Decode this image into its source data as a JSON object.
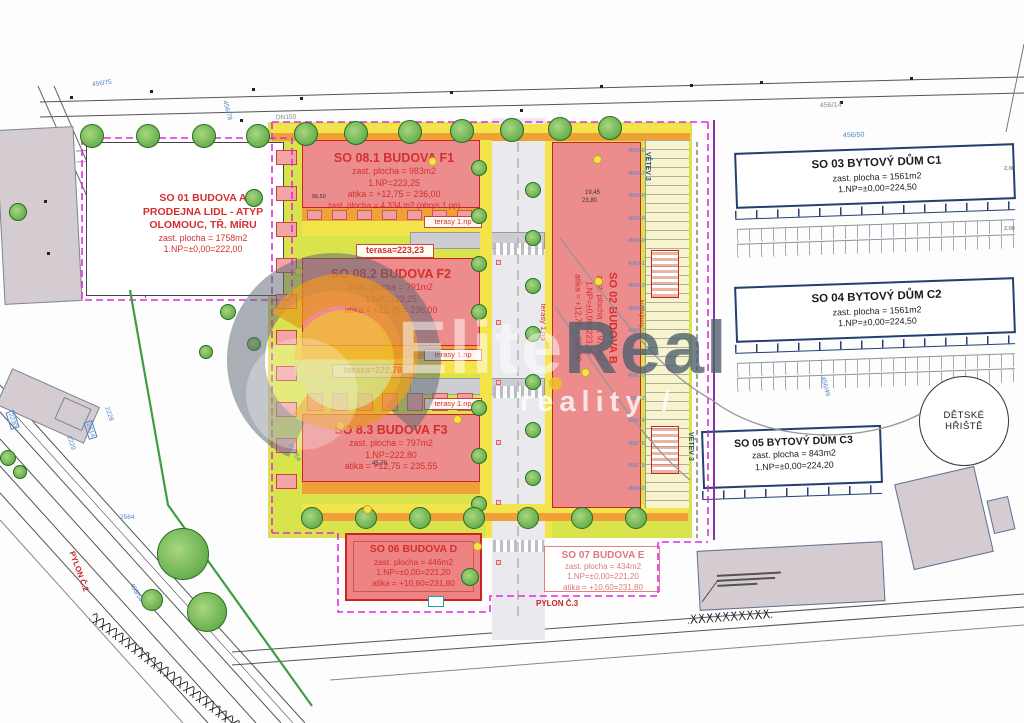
{
  "watermark": {
    "brand_left": "Elite",
    "brand_right": "Real",
    "subtitle": "reality /"
  },
  "site": {
    "so01": {
      "lines": [
        "SO 01 BUDOVA A",
        "PRODEJNA LIDL - ATYP",
        "OLOMOUC, TŘ. MÍRU",
        "zast. plocha = 1758m2",
        "1.NP=±0,00=222,00"
      ]
    },
    "so081": {
      "lines": [
        "SO 08.1  BUDOVA F1",
        "zast. plocha = 983m2",
        "1.NP=223,25",
        "atika = +12,75 = 236,00",
        "zast. plocha = 4 334 m2 (obrys 1.pp)"
      ]
    },
    "so082": {
      "lines": [
        "SO 08.2  BUDOVA F2",
        "zast. plocha = 791m2",
        "1.NP=223,25",
        "atika = +12,75 = 236,00"
      ]
    },
    "so83": {
      "lines": [
        "SO 8.3  BUDOVA F3",
        "zast. plocha = 797m2",
        "1.NP=222,80",
        "atika = +12,75 = 235,55"
      ]
    },
    "so02": {
      "lines": [
        "SO 02 BUDOVA B",
        "zast. plocha = 1 971m2",
        "1.NP=±0,00=223,25",
        "atika = +12,75 = 236,00"
      ]
    },
    "so03": {
      "lines": [
        "SO 03 BYTOVÝ DŮM C1",
        "zast. plocha = 1561m2",
        "1.NP=±0,00=224,50"
      ]
    },
    "so04": {
      "lines": [
        "SO 04 BYTOVÝ DŮM C2",
        "zast. plocha = 1561m2",
        "1.NP=±0,00=224,50"
      ]
    },
    "so05": {
      "lines": [
        "SO 05 BYTOVÝ DŮM C3",
        "zast. plocha = 843m2",
        "1.NP=±0,00=224,20"
      ]
    },
    "so06": {
      "lines": [
        "SO 06 BUDOVA D",
        "zast. plocha = 446m2",
        "1.NP=±0,00=221,20",
        "atika = +10,60=231,80"
      ]
    },
    "so07": {
      "lines": [
        "SO 07 BUDOVA E",
        "zast. plocha = 434m2",
        "1.NP=±0,00=221,20",
        "atika = +10,60=231,80"
      ]
    },
    "playground": {
      "line1": "DĚTSKÉ",
      "line2": "HŘIŠTĚ"
    }
  },
  "annotations": {
    "terasa_f1": "terasa=223,23",
    "terasa_f2": "terasa=222,78",
    "terasy": "terasy 1.np",
    "pylon2": "PYLON Č.2",
    "pylon3": "PYLON Č.3",
    "vetev": "VĚTEV 3",
    "kontejnery": "kontejnery",
    "dn150": "DN150"
  },
  "dimensions": {
    "d1": "19,45",
    "d2": "23,80",
    "d3": "45,70",
    "d4": "56,50",
    "d5": "2,00"
  },
  "parcels": {
    "p456_75": "456/75",
    "p456_78": "456/78",
    "p456_50": "456/50",
    "p456_14": "456/14",
    "p456_49": "456/49",
    "p456_54": "456/54",
    "p2228": "2228",
    "p2229": "2229",
    "p2230": "2230",
    "p2614": "2614",
    "p2564": "2564",
    "right_column": [
      "456/56",
      "456/57",
      "456/58",
      "456/59",
      "456/60",
      "456/61",
      "456/63",
      "456/65",
      "456/67",
      "456/69",
      "456/70",
      "456/72",
      "456/74",
      "456/76",
      "456/78",
      "456/80"
    ]
  },
  "colors": {
    "building_fill": "#ec8c8c",
    "building_border": "#cc2222",
    "label_red": "#d42f2f",
    "lime": "#d9e44c",
    "yellow": "#f4e44c",
    "orange": "#efa036",
    "boundary_magenta": "#e02ce0",
    "utility_purple": "#8b2fa8",
    "apartment_outline": "#23406e",
    "parcel_blue": "#4f86c6"
  }
}
